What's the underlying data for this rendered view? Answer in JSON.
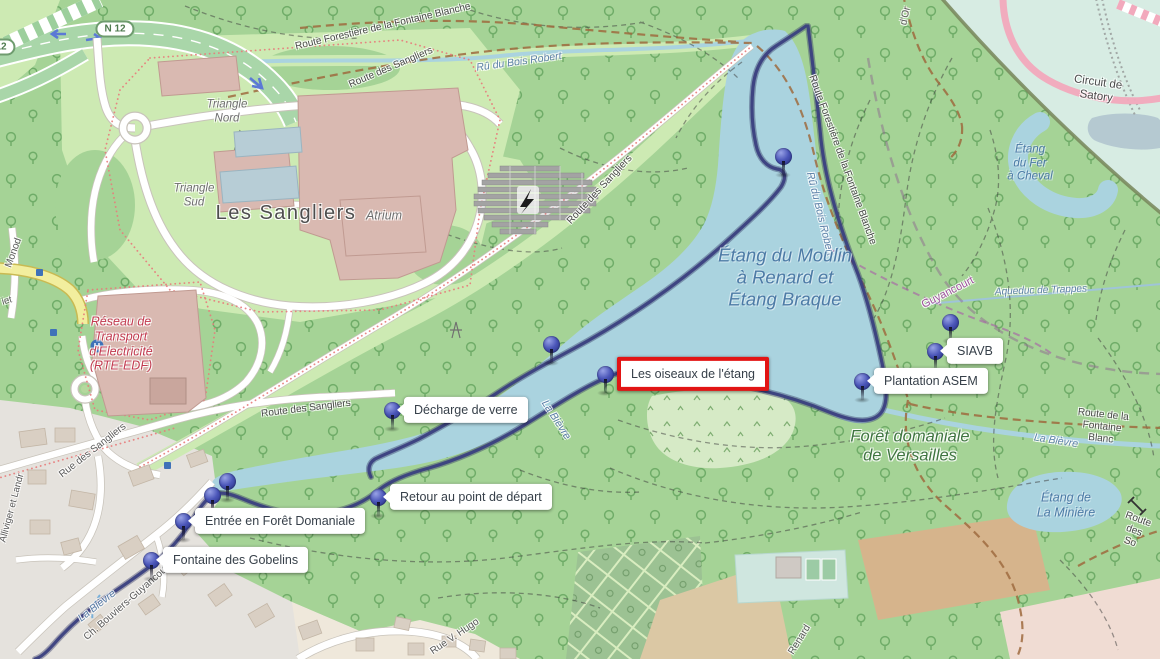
{
  "page": {
    "type": "interactive-map-with-waypoints",
    "width": 1160,
    "height": 659
  },
  "colors": {
    "water": "#aad3df",
    "forest": "#a5d396",
    "clearing": "#cdeab3",
    "route_track": "#3b4080",
    "marker_pin": "#4a55b8",
    "highlight_red": "#e21414",
    "circuit_pink": "#f2a9bc",
    "track_brown": "#9f6b3f",
    "building_pink": "#d9b9b1",
    "urban": "#e5e2dd",
    "mint_circuit_area": "#d7ece3"
  },
  "road_shield": {
    "text": "N 12",
    "instances": [
      {
        "x": 115,
        "y": 29
      },
      {
        "x": -4,
        "y": 47
      }
    ]
  },
  "markers": [
    {
      "id": "marquages",
      "label": "Marquages",
      "x": 783,
      "y": 156,
      "side": "left",
      "highlighted": false
    },
    {
      "id": "arbres-de-berge",
      "label": "Arbres de Berge",
      "x": 551,
      "y": 344,
      "side": "above",
      "highlighted": false
    },
    {
      "id": "les-oiseaux-de-l-etang",
      "label": "Les oiseaux de l'étang",
      "x": 605,
      "y": 374,
      "side": "right",
      "highlighted": true
    },
    {
      "id": "decharge-de-verre",
      "label": "Décharge de verre",
      "x": 392,
      "y": 410,
      "side": "right",
      "highlighted": false
    },
    {
      "id": "queue-de-l-etang-et-roseliere",
      "label": "Queue de l'étang et Roselière",
      "x": 227,
      "y": 481,
      "side": "above",
      "highlighted": false
    },
    {
      "id": "bancs-asem",
      "label": "Bancs ASEM",
      "x": 212,
      "y": 495,
      "side": "left",
      "highlighted": false
    },
    {
      "id": "entree-en-foret-domaniale",
      "label": "Entrée en Forêt Domaniale",
      "x": 183,
      "y": 521,
      "side": "right",
      "highlighted": false
    },
    {
      "id": "retour-au-point-de-depart",
      "label": "Retour au point de départ",
      "x": 378,
      "y": 497,
      "side": "right",
      "highlighted": false
    },
    {
      "id": "fontaine-des-gobelins",
      "label": "Fontaine des Gobelins",
      "x": 151,
      "y": 560,
      "side": "right",
      "highlighted": false
    },
    {
      "id": "recolte-de-bois",
      "label": "Récolte de bois",
      "x": 950,
      "y": 322,
      "side": "left",
      "highlighted": false
    },
    {
      "id": "siavb",
      "label": "SIAVB",
      "x": 935,
      "y": 351,
      "side": "right",
      "highlighted": false
    },
    {
      "id": "plantation-asem",
      "label": "Plantation ASEM",
      "x": 862,
      "y": 381,
      "side": "right",
      "highlighted": false
    }
  ],
  "map_labels": [
    {
      "text": "Route Forestière de la Fontaine Blanche",
      "kind": "road",
      "x": 383,
      "y": 27,
      "rot": -13,
      "size": 10
    },
    {
      "text": "Route des Sangliers",
      "kind": "road",
      "x": 391,
      "y": 68,
      "rot": -23,
      "size": 10
    },
    {
      "text": "Route des Sangliers",
      "kind": "road",
      "x": 600,
      "y": 190,
      "rot": -47,
      "size": 10
    },
    {
      "text": "Route des Sangliers",
      "kind": "road",
      "x": 306,
      "y": 409,
      "rot": -7,
      "size": 10
    },
    {
      "text": "Rue des Sangliers",
      "kind": "street",
      "x": 93,
      "y": 451,
      "rot": -38,
      "size": 10
    },
    {
      "text": "Route Forestière de la Fontaine Blanche",
      "kind": "road",
      "x": 842,
      "y": 160,
      "rot": 70,
      "size": 10
    },
    {
      "text": "Route de la Fontaine Blanc",
      "kind": "road",
      "x": 1102,
      "y": 427,
      "rot": 6,
      "size": 10
    },
    {
      "text": "Route des So",
      "kind": "road",
      "x": 1134,
      "y": 531,
      "rot": 20,
      "size": 10
    },
    {
      "text": "Circuit de Satory",
      "kind": "road",
      "x": 1097,
      "y": 90,
      "rot": 8,
      "size": 11.5
    },
    {
      "text": "Ch. Bouviers-Guyancourt",
      "kind": "street",
      "x": 128,
      "y": 602,
      "rot": -41,
      "size": 10
    },
    {
      "text": "Rue V. Hugo",
      "kind": "street",
      "x": 455,
      "y": 637,
      "rot": -34,
      "size": 10
    },
    {
      "text": "Renard",
      "kind": "street",
      "x": 800,
      "y": 640,
      "rot": -58,
      "size": 10
    },
    {
      "text": "d'Or",
      "kind": "street",
      "x": 906,
      "y": 16,
      "rot": -78,
      "size": 10
    },
    {
      "text": "Monod",
      "kind": "street",
      "x": 14,
      "y": 253,
      "rot": -70,
      "size": 10
    },
    {
      "text": "iet",
      "kind": "street",
      "x": 7,
      "y": 301,
      "rot": -15,
      "size": 9.5
    },
    {
      "text": "Alliviger et Landr",
      "kind": "street",
      "x": 12,
      "y": 508,
      "rot": -75,
      "size": 9.5
    },
    {
      "text": "Guyancourt",
      "kind": "boundary",
      "x": 948,
      "y": 293,
      "rot": -27,
      "size": 11
    },
    {
      "text": "Rû du Bois Robert",
      "kind": "stream",
      "x": 519,
      "y": 62,
      "rot": -8,
      "size": 10.5
    },
    {
      "text": "Rû du Bois Robert",
      "kind": "stream",
      "x": 820,
      "y": 214,
      "rot": 76,
      "size": 10.5
    },
    {
      "text": "La Bièvre",
      "kind": "stream",
      "x": 556,
      "y": 420,
      "rot": 57,
      "size": 10.5
    },
    {
      "text": "La Bièvre",
      "kind": "stream",
      "x": 1056,
      "y": 441,
      "rot": 9,
      "size": 10.5
    },
    {
      "text": "La Bièvre",
      "kind": "stream",
      "x": 97,
      "y": 606,
      "rot": -38,
      "size": 10.5
    },
    {
      "text": "Aqueduc de Trappes",
      "kind": "stream",
      "x": 1041,
      "y": 291,
      "rot": -2,
      "size": 10
    },
    {
      "text": "Étang du Moulin\nà Renard et\nÉtang Braque",
      "kind": "water-area",
      "x": 785,
      "y": 277,
      "rot": 0,
      "size": 18.5
    },
    {
      "text": "Étang\ndu Fer\nà Cheval",
      "kind": "water-area",
      "x": 1030,
      "y": 164,
      "rot": 0,
      "size": 11.5
    },
    {
      "text": "Étang de\nLa Minière",
      "kind": "water-area",
      "x": 1066,
      "y": 505,
      "rot": 0,
      "size": 12.5
    },
    {
      "text": "Triangle\nNord",
      "kind": "place",
      "x": 227,
      "y": 112,
      "rot": 0,
      "size": 11.5
    },
    {
      "text": "Triangle\nSud",
      "kind": "place",
      "x": 194,
      "y": 196,
      "rot": 0,
      "size": 11.5
    },
    {
      "text": "Les Sangliers",
      "kind": "locality",
      "x": 286,
      "y": 214,
      "rot": 0,
      "size": 20
    },
    {
      "text": "Atrium",
      "kind": "place",
      "x": 384,
      "y": 216,
      "rot": 0,
      "size": 12.5
    },
    {
      "text": "Forêt domaniale\nde Versailles",
      "kind": "forest",
      "x": 910,
      "y": 447,
      "rot": 0,
      "size": 16.5
    },
    {
      "text": "Réseau de\nTransport\nd'Electricité\n(RTE-EDF)",
      "kind": "poi-red",
      "x": 121,
      "y": 344,
      "rot": 0,
      "size": 12.5
    }
  ]
}
